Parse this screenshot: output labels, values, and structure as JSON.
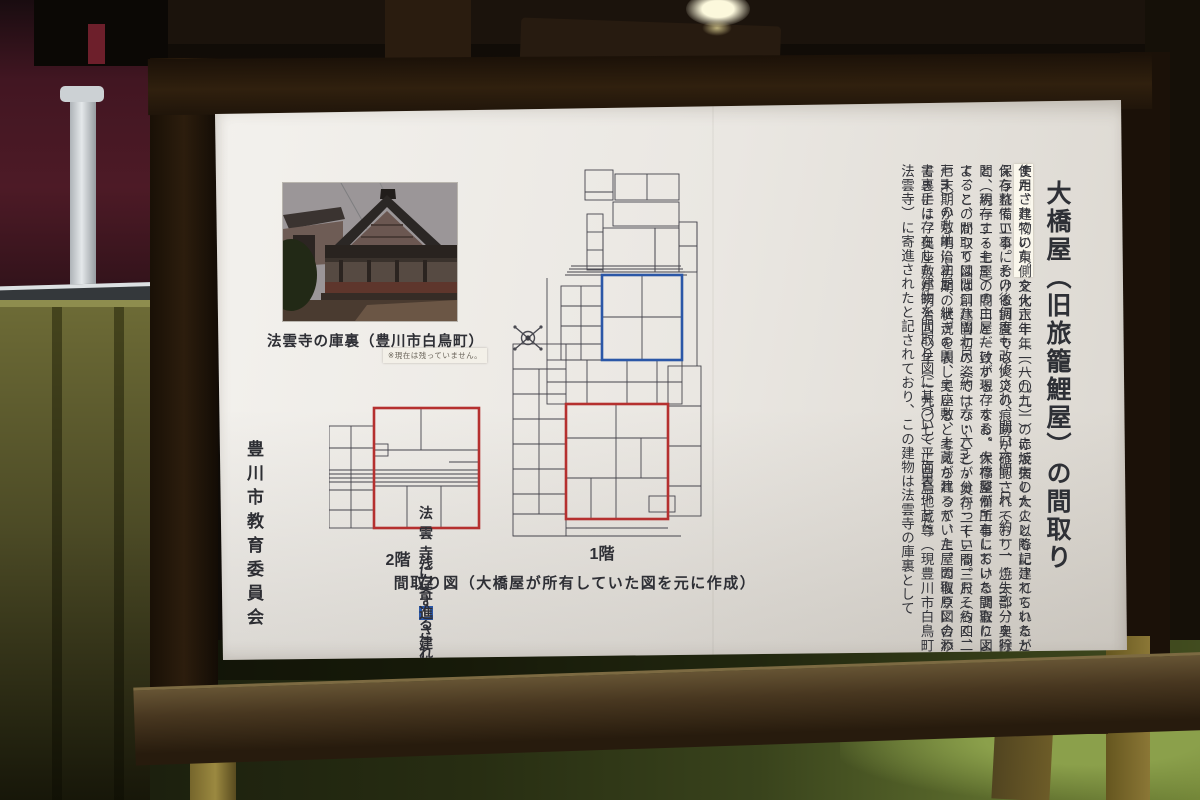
{
  "sign": {
    "title": "大橋屋（旧旅籠鯉屋）の間取り",
    "body": {
      "part1": "　大橋屋建物は、文化六年（一八〇九）の赤坂宿の大火以降に建てられたと考えられている。その後何度も改修され、間口六間一尺（約一一・二m）、奥行七間（約一二・七m）の主屋だけが現存する。大橋屋が所有していた間取り図によると、かつては間口八間七尺（約一六・六m）・奥行二十三間三尺（約四二・七m）の敷地に主屋、継ぎの間、奥座敷、土蔵が建っていた。間取り図の添え書きには、奥座敷が明治四〇年（一九〇七）に白鳥地蔵尊（現豊川市白鳥町・法雲寺）に寄進されたと記されており、この建物は法雲寺の庫裏として",
      "highlight": "使用されていた。",
      "part2": "また、建物の東側を大正十年（一九二一）に焼失したことも記されているが、保存整備工事における調査でも火災の痕跡が確認されており、焼失部分を除くと、現存する主屋の間口と一致する。なお、保存整備工事における調査によって、この間取り図は創建当初の姿ではないことが分かっている。おそらく、江戸末期から明治初期の状況を表していると考えられるが、主屋の復原に合わせて裏手に存在した建物を間取り図に基づいて平面表示した。"
    },
    "photo": {
      "caption": "法雲寺の庫裏（豊川市白鳥町）",
      "note": "※現在は残っていません。"
    },
    "plans": {
      "floor2_label": "2階",
      "floor1_label": "1階",
      "caption": "間取り図（大橋屋が所有していた図を元に作成）"
    },
    "legend": {
      "surviving": {
        "label": "残存する建物",
        "color": "#b5302f"
      },
      "donated": {
        "label": "法雲寺に寄進された建物",
        "color": "#2b57a7"
      }
    },
    "organization": "豊川市教育委員会"
  }
}
